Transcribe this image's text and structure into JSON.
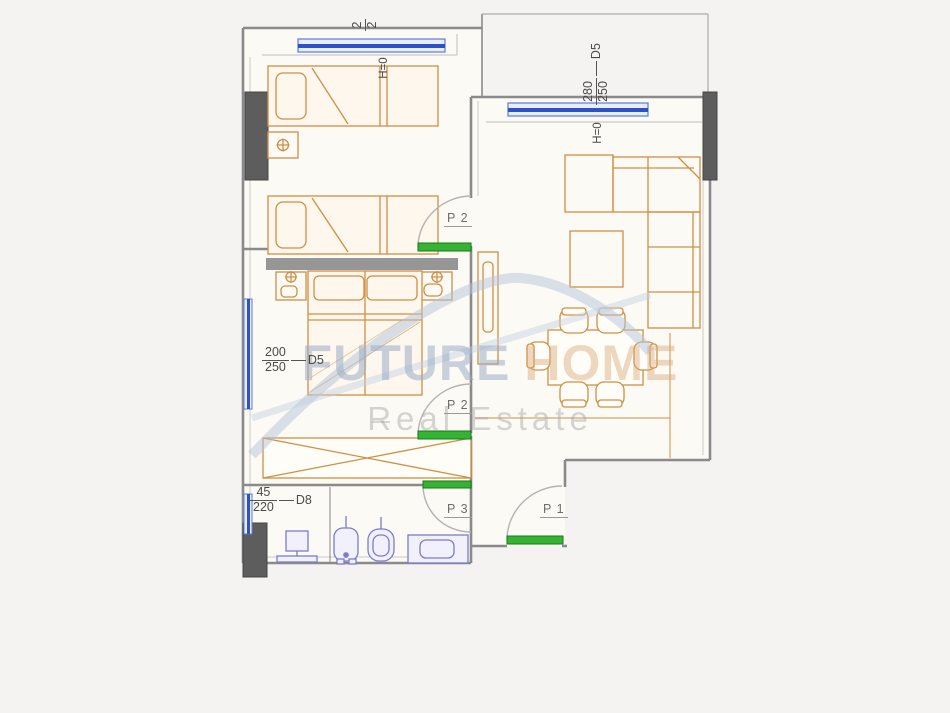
{
  "dimensions": {
    "win_top_left": {
      "num": "2",
      "den": "2"
    },
    "win_top_right": {
      "num": "280",
      "den": "250",
      "code": "D5"
    },
    "win_left_mid": {
      "num": "200",
      "den": "250",
      "code": "D5"
    },
    "win_left_bottom": {
      "num": "45",
      "den": "220",
      "code": "D8"
    }
  },
  "height_labels": {
    "a": "H=0",
    "b": "H=0"
  },
  "door_labels": {
    "p1": "P 1",
    "p2_top": "P 2",
    "p2_mid": "P 2",
    "p3": "P 3"
  },
  "watermark": {
    "word1": "FUTURE",
    "word2": "HOME",
    "tagline": "Real Estate"
  },
  "colors": {
    "wall": "#8a8a8a",
    "column_fill": "#5d5d5d",
    "window_blue": "#2e52c4",
    "door_green": "#35b335",
    "furniture_orange": "#cf8f44",
    "fixture_blue": "#7b7bd0",
    "watermark_blue": "#b3c4d9"
  }
}
